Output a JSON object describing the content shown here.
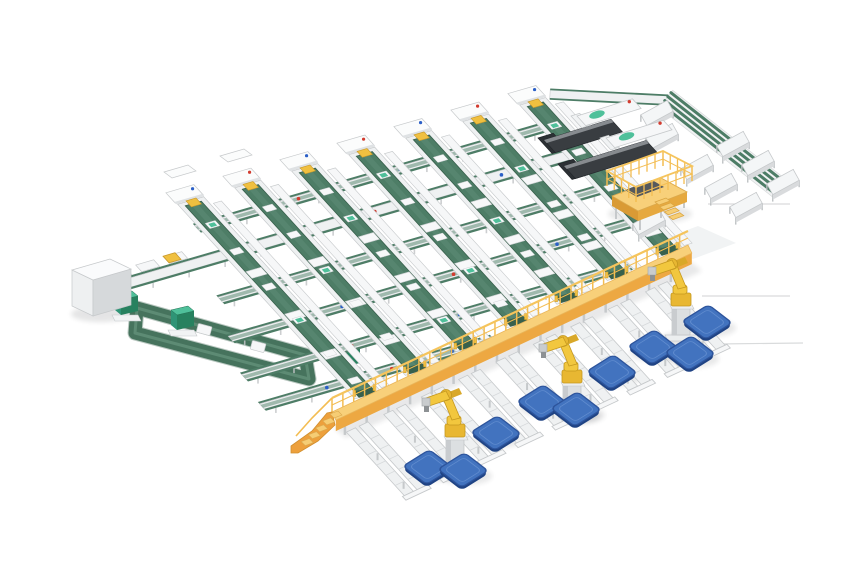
{
  "description": "Isometric 3D render of an automated parcel sorting and palletizing facility: grid of green belt sorter lanes, yellow elevated walkway with stairs, palletizing robots, blue pallets, telescopic truck loaders with scanner stations, operator platform, tote conveyor loop and control cabinet. No visible text.",
  "canvas": {
    "width": 860,
    "height": 580,
    "background": "#ffffff"
  },
  "palette": {
    "belt_green": "#4d7d66",
    "belt_green_light": "#5d8b74",
    "belt_green_dark": "#38604c",
    "frame_white": "#eff1f2",
    "frame_light": "#f6f7f8",
    "rail_gray": "#c6c9cb",
    "mid_gray": "#dcdfe1",
    "walkway_deck": "#f8d07a",
    "walkway_side": "#eda842",
    "walkway_rail": "#f3bd52",
    "stairs_side": "#eda03c",
    "step_yellow": "#f6cd74",
    "robot_yellow": "#f2c73e",
    "robot_shade": "#e8b732",
    "robot_outline": "#c5981f",
    "pallet_top": "#4273bf",
    "pallet_side": "#1f4384",
    "pallet_rim": "#2d549c",
    "loader_dark": "#393d41",
    "loader_top": "#878b8f",
    "loader_head": "#2c3034",
    "teal": "#4fc09a",
    "teal_front": "#2f9476",
    "teal_side": "#27815f",
    "dot_red": "#d23b2f",
    "dot_blue": "#2b5fc7",
    "table_top": "#f4f6f7",
    "table_front": "#d9dbdd",
    "leg_gray": "#b9bdbf",
    "cabinet_top": "#fafbfc",
    "cabinet_front": "#eef0f1",
    "cabinet_side": "#d6d9db",
    "shadow": "#2a2e33",
    "floor_line": "#d9dbdc",
    "accent_yellow_box": "#f0c040"
  },
  "grid": {
    "origin": [
      192,
      202
    ],
    "u": [
      1,
      -0.29
    ],
    "v": [
      0.673,
      0.739
    ],
    "lane_count": 7,
    "lane_spacing": 57,
    "frame_width": 26,
    "belt_width": 16,
    "companion_offset": 16,
    "companion_width": 8,
    "walkway_lane_space": {
      "t0": 268.3,
      "slope": 0.1699,
      "x_off": 40.6
    },
    "main_lines": [
      {
        "t": 26,
        "x0": -15,
        "x1": 348,
        "kind": "green"
      },
      {
        "t": 62,
        "x0": -135,
        "x1": 352,
        "kind": "white"
      },
      {
        "t": 110,
        "x0": -48,
        "x1": 348,
        "kind": "green"
      },
      {
        "t": 155,
        "x0": -68,
        "x1": 330,
        "kind": "green"
      },
      {
        "t": 200,
        "x0": -85,
        "x1": 300,
        "kind": "green"
      },
      {
        "t": 237,
        "x0": -92,
        "x1": 140,
        "kind": "green"
      }
    ],
    "carrier_fractions": [
      0.38,
      0.6,
      0.8
    ],
    "dot_fractions": [
      0.28,
      0.56,
      0.82
    ]
  },
  "extra_stations": [
    [
      176,
      172
    ],
    [
      232,
      156
    ]
  ],
  "m0_plates": [
    [
      -118,
      50
    ],
    [
      -90,
      50
    ],
    [
      -62,
      50
    ]
  ],
  "yellow_box": {
    "x": -62,
    "t": 49,
    "len": 12,
    "w": 9
  },
  "u_loop": {
    "ring": [
      [
        137,
        308
      ],
      [
        305,
        355
      ],
      [
        309,
        379
      ],
      [
        135,
        333
      ]
    ],
    "stroke_w": 13,
    "carriers": [
      [
        204,
        330
      ],
      [
        258,
        347
      ]
    ]
  },
  "teal_machines": [
    [
      125,
      307
    ],
    [
      181,
      322
    ],
    [
      347,
      359
    ]
  ],
  "cabinet": {
    "top": [
      [
        72,
        270
      ],
      [
        110,
        259
      ],
      [
        131,
        269
      ],
      [
        93,
        280
      ]
    ],
    "front": [
      [
        72,
        270
      ],
      [
        93,
        280
      ],
      [
        93,
        316
      ],
      [
        72,
        306
      ]
    ],
    "side": [
      [
        93,
        280
      ],
      [
        131,
        269
      ],
      [
        131,
        305
      ],
      [
        93,
        316
      ]
    ]
  },
  "walkway": {
    "a": [
      332,
      412
    ],
    "b": [
      688,
      245
    ],
    "deck_w": 9,
    "side_h": 11,
    "rail_h": 14,
    "post_gap": 12,
    "leg_gap": 24,
    "stairs_panel": [
      [
        332,
        412
      ],
      [
        335,
        425
      ],
      [
        318,
        441
      ],
      [
        298,
        453
      ],
      [
        291,
        453
      ],
      [
        291,
        446
      ],
      [
        312,
        431
      ],
      [
        327,
        413
      ]
    ],
    "stairs_steps": 5,
    "stairs_step0": [
      330,
      414
    ],
    "stairs_step_vec": [
      -7.2,
      6.9
    ]
  },
  "spurs": {
    "fractions": [
      0.03,
      0.135,
      0.24,
      0.345,
      0.45,
      0.555,
      0.66,
      0.765,
      0.87
    ],
    "start_pad": 16,
    "length": 86,
    "bed_half": 12
  },
  "robots": [
    [
      455,
      468
    ],
    [
      572,
      414
    ],
    [
      681,
      337
    ]
  ],
  "pallets": [
    [
      428,
      467
    ],
    [
      463,
      470
    ],
    [
      496,
      433
    ],
    [
      542,
      402
    ],
    [
      576,
      409
    ],
    [
      612,
      372
    ],
    [
      653,
      347
    ],
    [
      690,
      353
    ],
    [
      707,
      322
    ]
  ],
  "loaders": [
    {
      "p": [
        544,
        140
      ],
      "len": 70
    },
    {
      "p": [
        564,
        166
      ],
      "len": 86
    }
  ],
  "scanners": [
    {
      "p": [
        577,
        116
      ],
      "len": 58
    },
    {
      "p": [
        606,
        138
      ],
      "len": 60
    }
  ],
  "corner_line": {
    "a": [
      550,
      94
    ],
    "b": [
      668,
      100
    ]
  },
  "band": {
    "a": [
      666,
      99
    ],
    "b": [
      779,
      188
    ],
    "offsets": [
      -8,
      -3,
      2,
      7
    ],
    "underlay_half": 11
  },
  "tables": [
    [
      697,
      167
    ],
    [
      721,
      186
    ],
    [
      746,
      205
    ],
    [
      649,
      222
    ],
    [
      733,
      144
    ],
    [
      758,
      163
    ],
    [
      783,
      182
    ],
    [
      657,
      113
    ],
    [
      662,
      136
    ]
  ],
  "platform": {
    "deck": [
      [
        612,
        196
      ],
      [
        661,
        178
      ],
      [
        687,
        192
      ],
      [
        638,
        211
      ]
    ],
    "side_h": 10,
    "fence": [
      [
        607,
        186
      ],
      [
        663,
        166
      ],
      [
        692,
        181
      ],
      [
        636,
        202
      ]
    ],
    "fence_h": 15,
    "chute": [
      [
        625,
        190
      ],
      [
        652,
        180
      ],
      [
        664,
        187
      ],
      [
        637,
        197
      ]
    ],
    "stairs_origin": [
      655,
      200
    ],
    "stairs_steps": 4,
    "stairs_step_vec": [
      4.6,
      4.9
    ],
    "legs": [
      [
        616,
        208
      ],
      [
        640,
        219
      ],
      [
        684,
        197
      ],
      [
        661,
        207
      ]
    ]
  },
  "floor_lines": [
    [
      [
        708,
        204
      ],
      [
        790,
        204
      ]
    ],
    [
      [
        702,
        296
      ],
      [
        790,
        296
      ]
    ],
    [
      [
        716,
        344
      ],
      [
        803,
        343
      ]
    ]
  ],
  "floor_patch": [
    [
      655,
      242
    ],
    [
      698,
      226
    ],
    [
      736,
      243
    ],
    [
      693,
      259
    ]
  ]
}
